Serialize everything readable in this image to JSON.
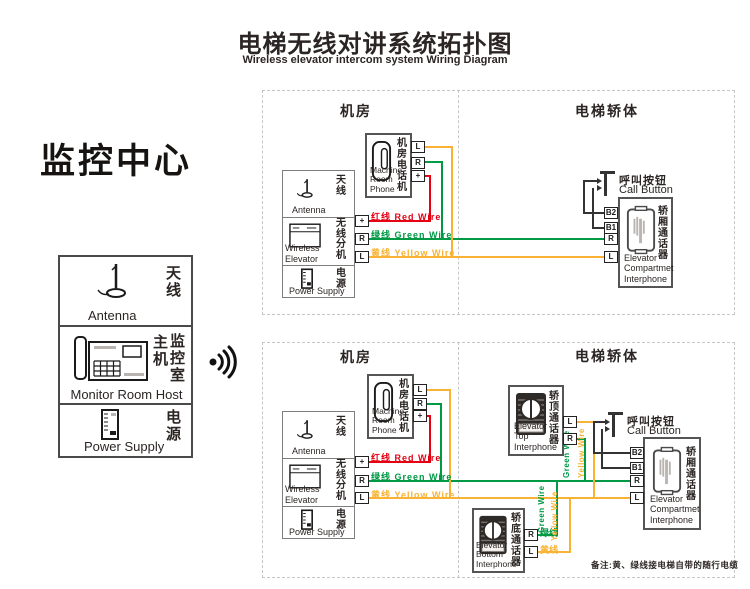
{
  "header": {
    "title": "电梯无线对讲系统拓扑图",
    "subtitle": "Wireless elevator intercom system Wiring Diagram"
  },
  "monitor_center": {
    "title": "监控中心",
    "antenna": {
      "zh": "天\n线",
      "en": "Antenna"
    },
    "host": {
      "zh_left": "主\n机",
      "zh_right": "监\n控\n室",
      "en": "Monitor Room Host"
    },
    "power": {
      "zh": "电\n源",
      "en": "Power Supply"
    }
  },
  "sections": {
    "room": "机房",
    "car": "电梯轿体"
  },
  "machine_phone": {
    "zh": "机\n房\n电\n话\n机",
    "en": "Machine\nRoom Phone",
    "t_l": "L",
    "t_r": "R",
    "t_plus": "+"
  },
  "station": {
    "antenna": {
      "zh": "天\n线",
      "en": "Antenna"
    },
    "wireless": {
      "zh": "无\n线\n分\n机",
      "en": "Wireless Elevator"
    },
    "power": {
      "zh": "电\n源",
      "en": "Power Supply"
    },
    "t_plus": "+",
    "t_r": "R",
    "t_l": "L"
  },
  "wires": {
    "red": {
      "label": "红线   Red Wire",
      "color": "#e60012"
    },
    "green": {
      "label": "绿线  Green Wire",
      "color": "#009944"
    },
    "yellow": {
      "label": "黄线  Yellow Wire",
      "color": "#f9b233"
    },
    "green_vertical_label": "Green Wire",
    "yellow_vertical_label": "Yellow Wire",
    "green_short": "绿线",
    "yellow_short": "黄线"
  },
  "call_button": {
    "zh": "呼叫按钮",
    "en": "Call Button"
  },
  "compartment": {
    "zh": "轿\n厢\n通\n话\n器",
    "en": "Elevator\nCompartmet\nInterphone",
    "t_b2": "B2",
    "t_b1": "B1",
    "t_r": "R",
    "t_l": "L"
  },
  "top_interphone": {
    "zh": "轿\n顶\n通\n话\n器",
    "en": "Elevator Top\nInterphone",
    "t_l": "L",
    "t_r": "R"
  },
  "bottom_interphone": {
    "zh": "轿\n底\n通\n话\n器",
    "en": "Elevator Bottom\nInterphone",
    "t_r": "R",
    "t_l": "L"
  },
  "note": "备注:黄、绿线接电梯自带的随行电缆"
}
